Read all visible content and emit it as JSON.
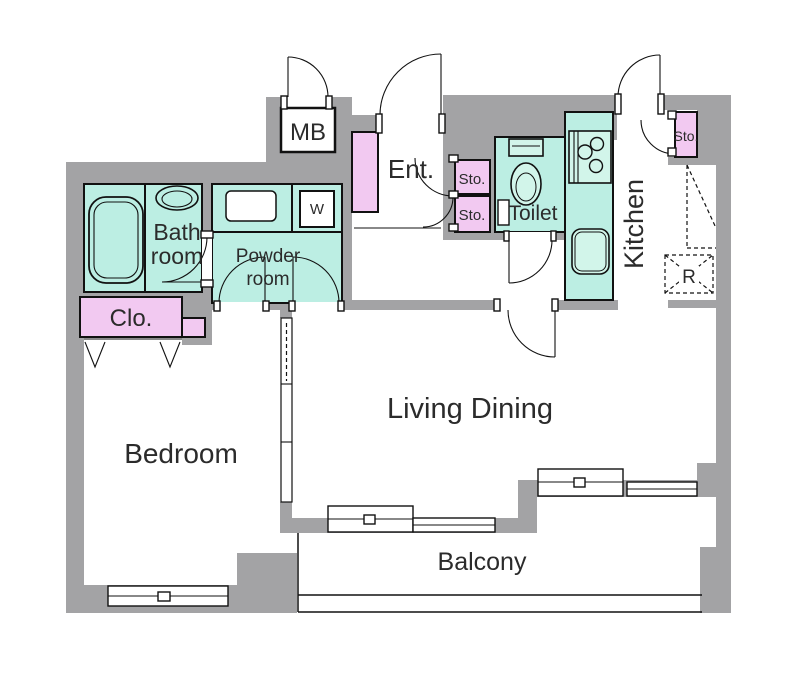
{
  "labels": {
    "meter_box": "MB",
    "entrance": "Ent.",
    "storage_upper": "Sto.",
    "storage_lower": "Sto.",
    "toilet": "Toilet",
    "kitchen": "Kitchen",
    "kitchen_storage": "Sto.",
    "refrigerator": "R",
    "washer": "W",
    "bath_line1": "Bath",
    "bath_line2": "room",
    "powder_line1": "Powder",
    "powder_line2": "room",
    "closet": "Clo.",
    "bedroom": "Bedroom",
    "living_dining": "Living Dining",
    "balcony": "Balcony"
  },
  "colors": {
    "wall_gray": "#a3a3a5",
    "room_mint": "#bceee3",
    "fixture_mint": "#d2f5ea",
    "accent_pink": "#f2c9f1",
    "line_black": "#111111",
    "background": "#ffffff"
  }
}
